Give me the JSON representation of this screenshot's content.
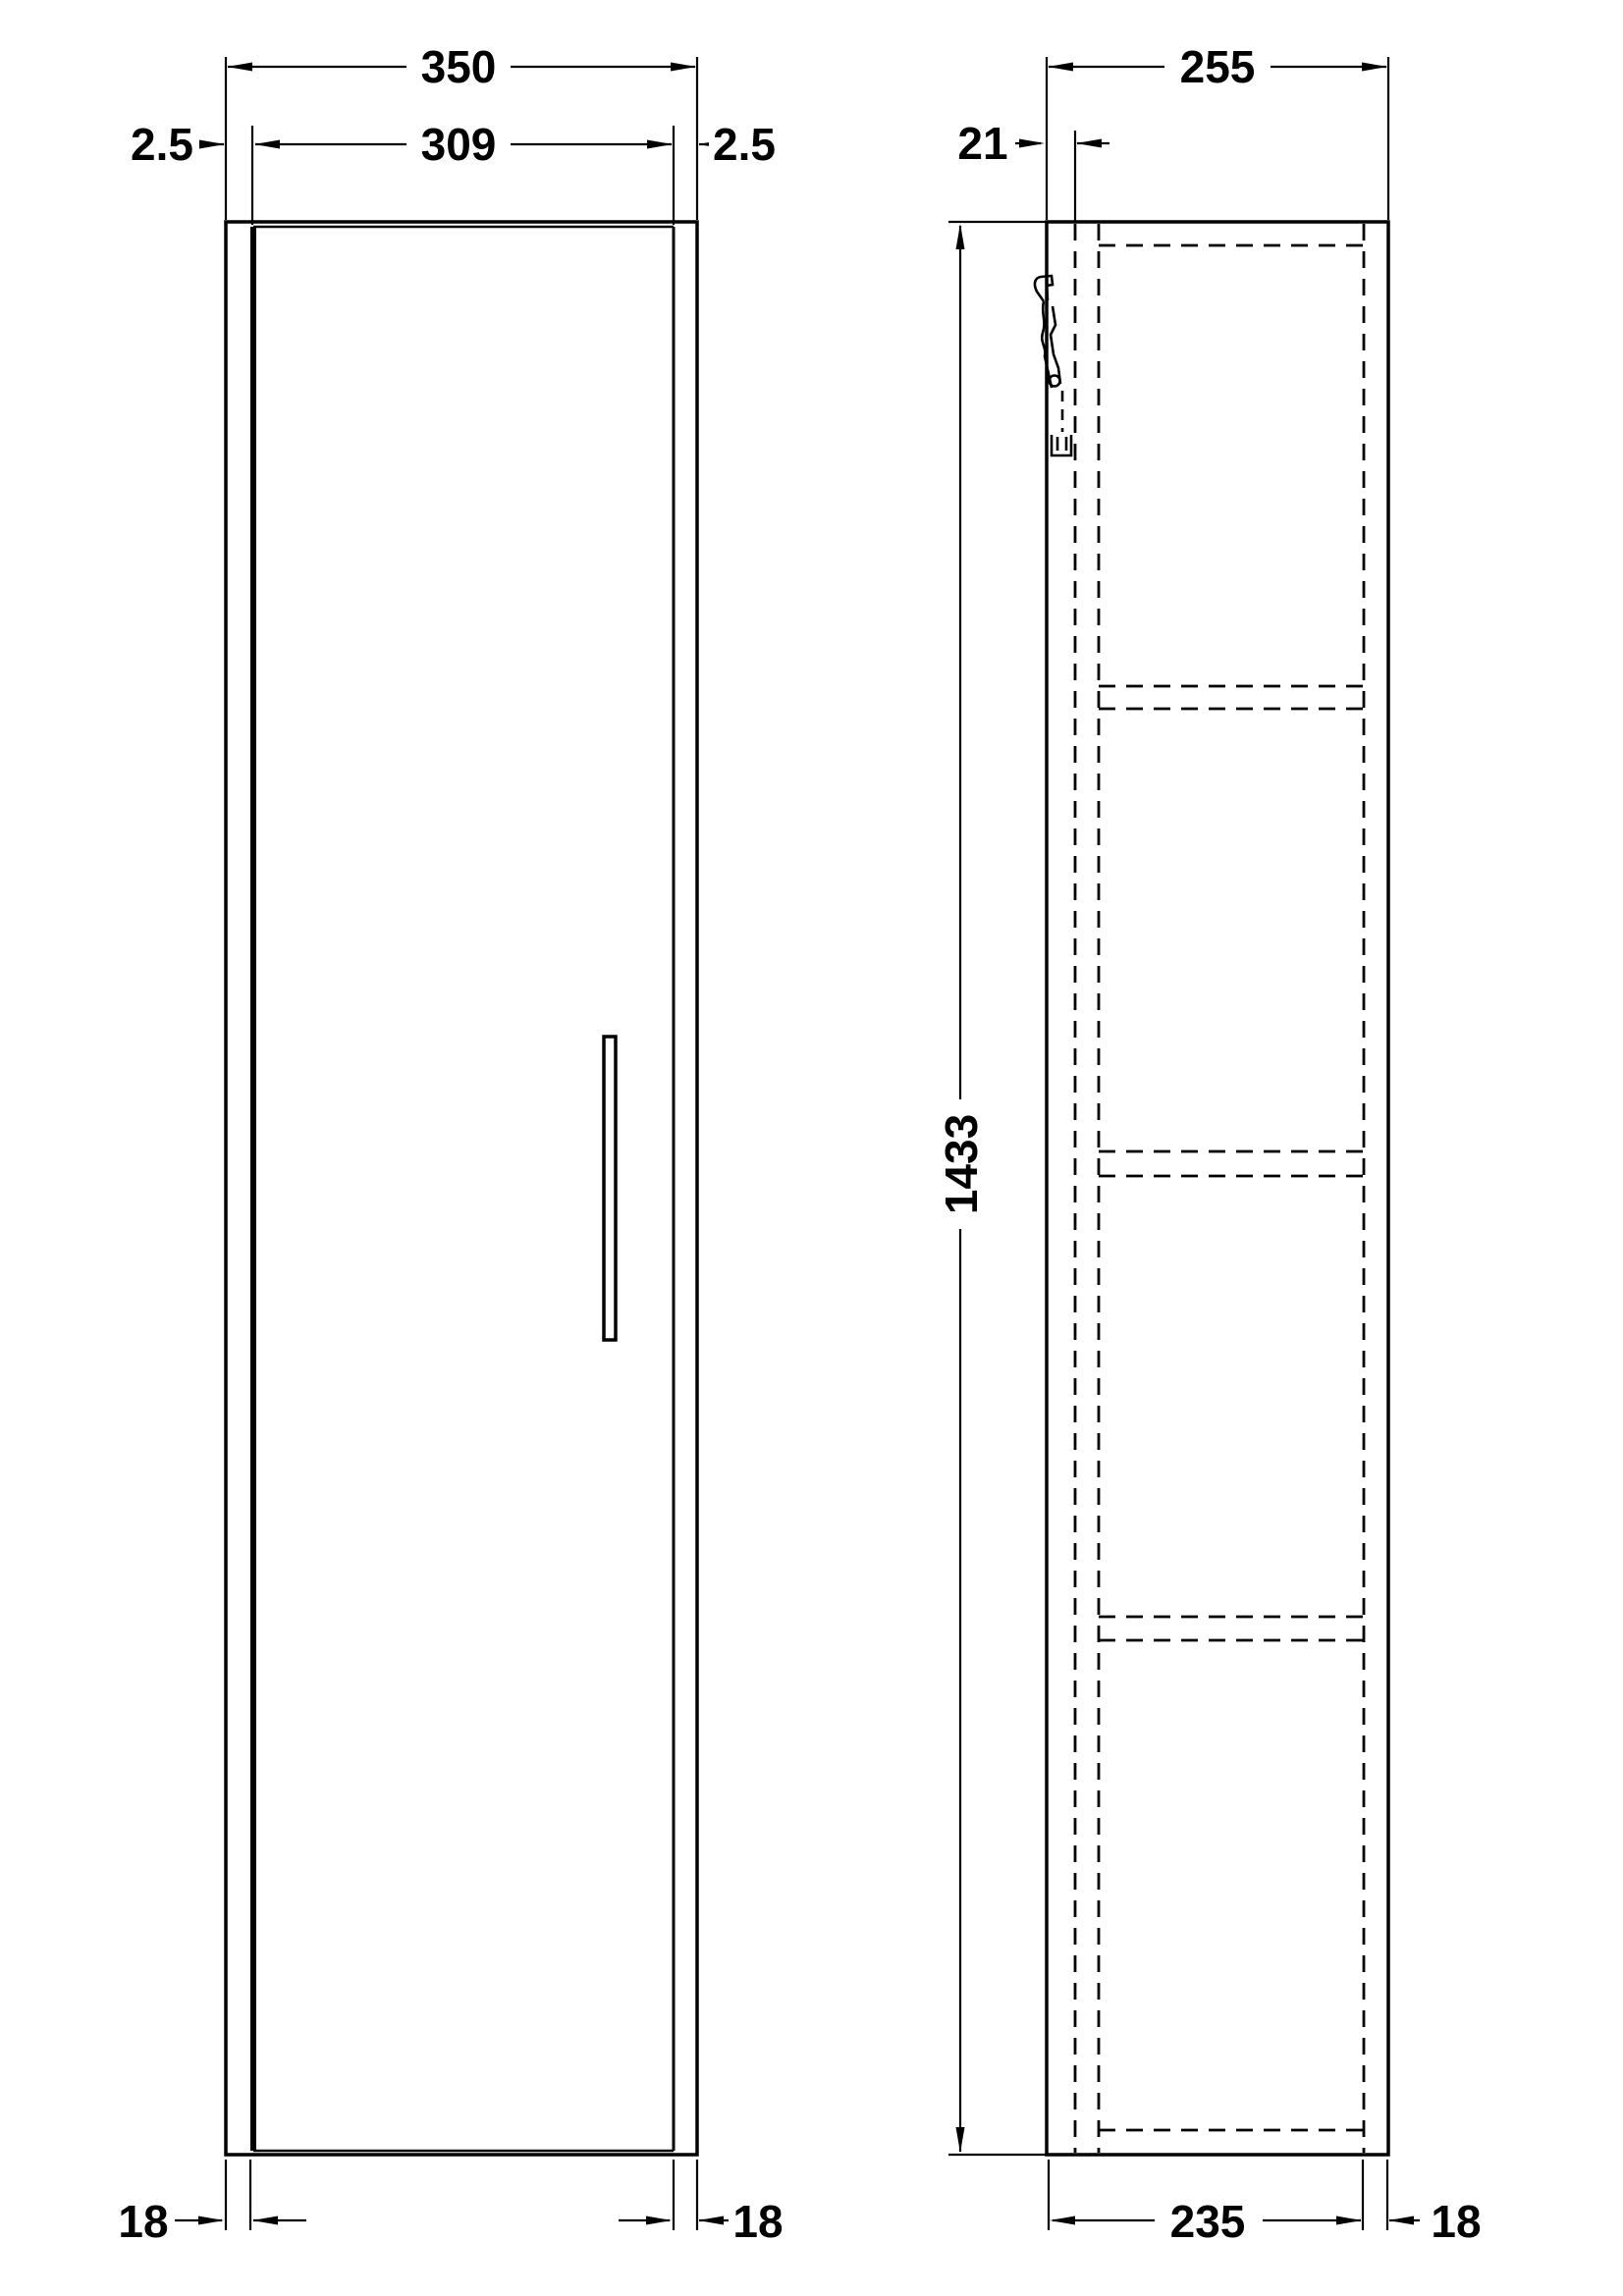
{
  "drawing": {
    "type": "technical-orthographic-drawing",
    "subject": "tall-wall-hung-cabinet",
    "views": {
      "front_view": {
        "dims": {
          "overall_width": "350",
          "door_width": "309",
          "door_gap_left": "2.5",
          "door_gap_right": "2.5",
          "side_panel_left": "18",
          "side_panel_right": "18"
        }
      },
      "side_view": {
        "dims": {
          "overall_depth": "255",
          "door_thickness": "21",
          "overall_height": "1433",
          "carcass_depth": "235",
          "back_panel_thickness": "18"
        }
      }
    },
    "icons": {
      "hinge": "hinge-icon"
    },
    "colors": {
      "line": "#000000",
      "background": "#ffffff"
    }
  }
}
